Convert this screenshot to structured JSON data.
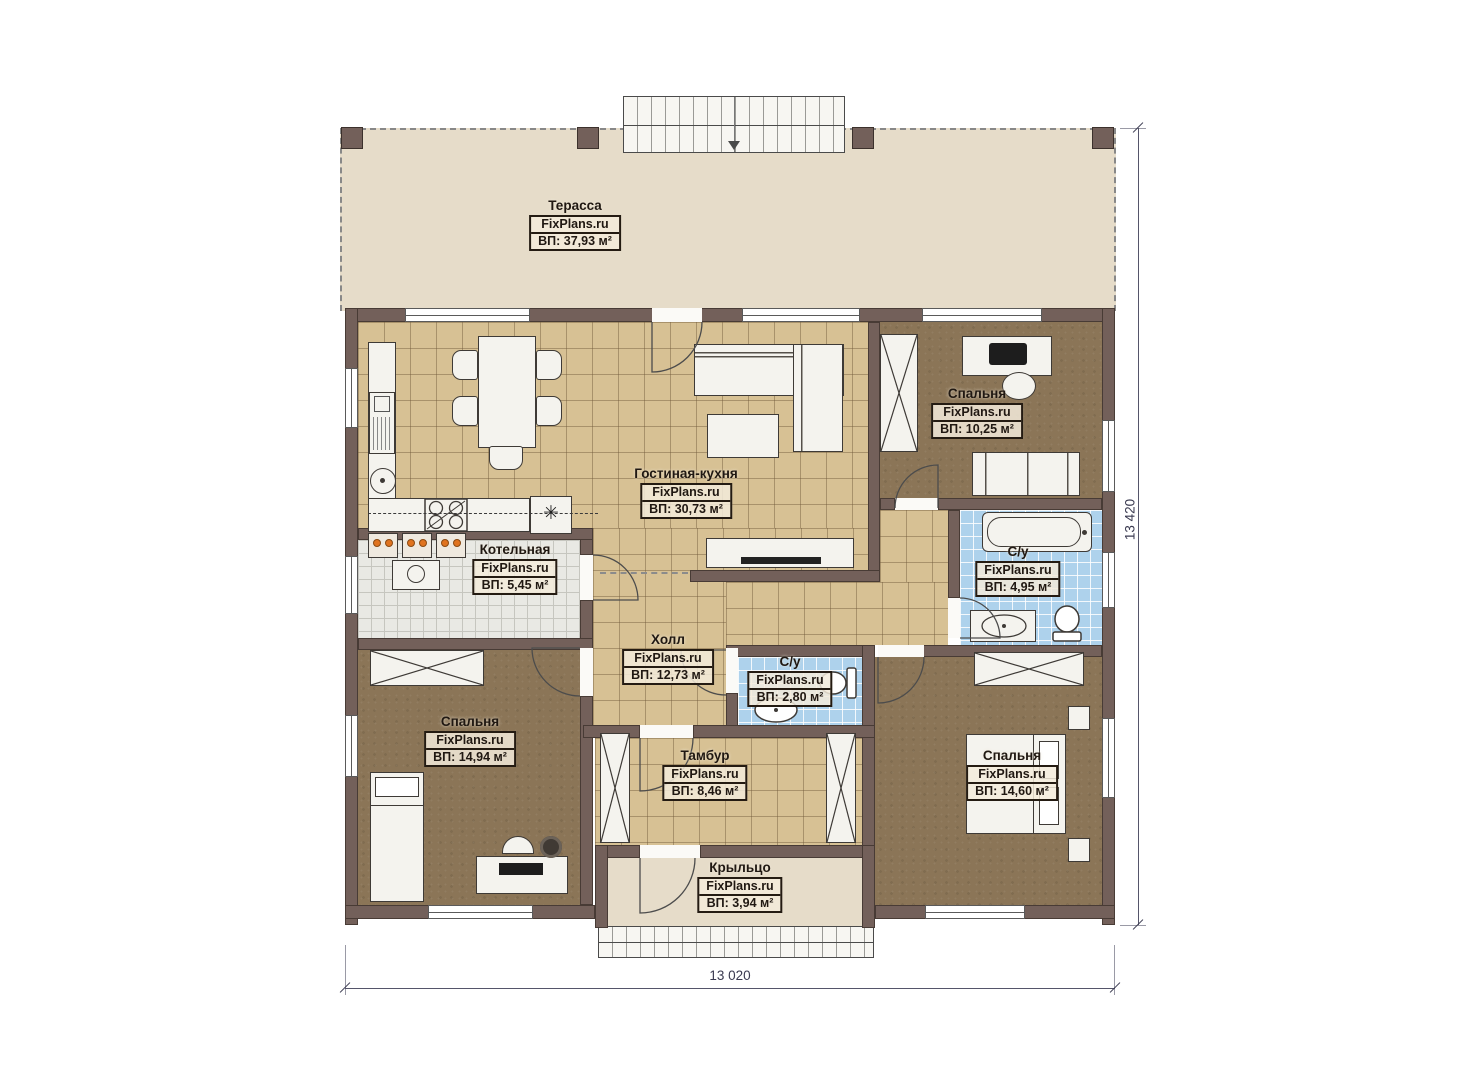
{
  "brand": "FixPlans.ru",
  "rooms": [
    {
      "name": "Терасса",
      "area": "ВП: 37,93 м²"
    },
    {
      "name": "Гостиная-кухня",
      "area": "ВП: 30,73 м²"
    },
    {
      "name": "Спальня",
      "area": "ВП: 10,25 м²"
    },
    {
      "name": "С/у",
      "area": "ВП: 4,95 м²"
    },
    {
      "name": "Котельная",
      "area": "ВП: 5,45 м²"
    },
    {
      "name": "Холл",
      "area": "ВП: 12,73 м²"
    },
    {
      "name": "С/у",
      "area": "ВП: 2,80 м²"
    },
    {
      "name": "Спальня",
      "area": "ВП: 14,94 м²"
    },
    {
      "name": "Тамбур",
      "area": "ВП: 8,46 м²"
    },
    {
      "name": "Спальня",
      "area": "ВП: 14,60 м²"
    },
    {
      "name": "Крыльцо",
      "area": "ВП: 3,94 м²"
    }
  ],
  "dimensions": {
    "width_label": "13 020",
    "height_label": "13 420"
  },
  "symbols": {
    "fridge_marker": "✳"
  },
  "colors": {
    "wall": "#73605a",
    "tile_floor": "#d7c194",
    "bathroom_floor": "#aed2ec",
    "bedroom_floor": "#8b7557",
    "utility_floor": "#e9e9e4",
    "terrace_floor": "#e6dcc9",
    "equipment_accent": "#e0731f",
    "dimension_text": "#3a3a50"
  }
}
